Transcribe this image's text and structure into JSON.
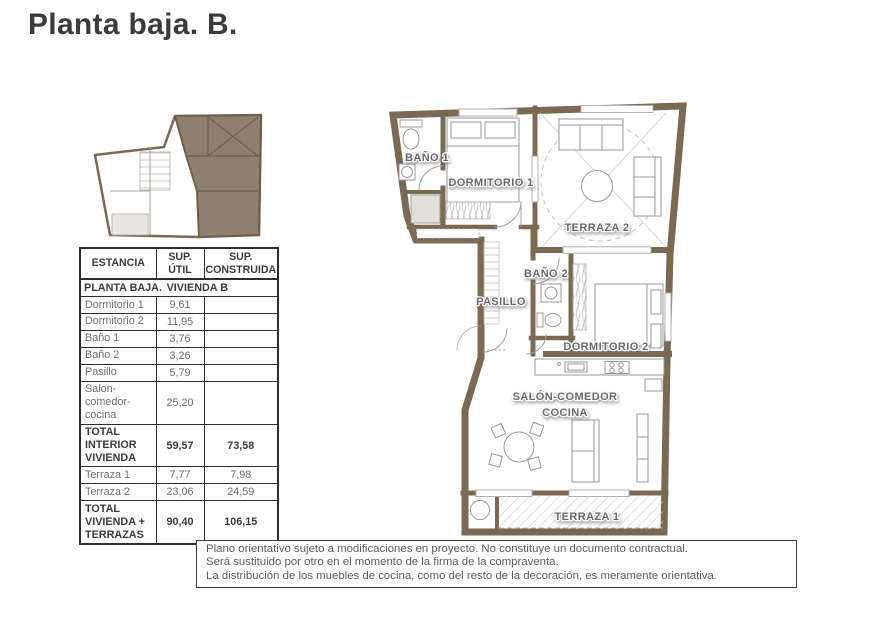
{
  "title": "Planta baja. B.",
  "table": {
    "col_headers": [
      "ESTANCIA",
      "SUP. ÚTIL",
      "SUP. CONSTRUIDA"
    ],
    "section": {
      "left": "PLANTA BAJA.",
      "right": "VIVIENDA B"
    },
    "rows": [
      {
        "label": "Dormitorio 1",
        "util": "9,61",
        "cons": ""
      },
      {
        "label": "Dormitorio 2",
        "util": "11,95",
        "cons": ""
      },
      {
        "label": "Baño 1",
        "util": "3,76",
        "cons": ""
      },
      {
        "label": "Baño 2",
        "util": "3,26",
        "cons": ""
      },
      {
        "label": "Pasillo",
        "util": "5,79",
        "cons": ""
      },
      {
        "label": "Salon-comedor-cocina",
        "util": "25,20",
        "cons": ""
      },
      {
        "label": "TOTAL INTERIOR VIVIENDA",
        "util": "59,57",
        "cons": "73,58"
      },
      {
        "label": "Terraza 1",
        "util": "7,77",
        "cons": "7,98"
      },
      {
        "label": "Terraza 2",
        "util": "23,06",
        "cons": "24,59"
      },
      {
        "label": "TOTAL VIVIENDA + TERRAZAS",
        "util": "90,40",
        "cons": "106,15"
      }
    ]
  },
  "floor_plan": {
    "labels": {
      "bano1": "BAÑO 1",
      "dormitorio1": "DORMITORIO 1",
      "terraza2": "TERRAZA 2",
      "bano2": "BAÑO 2",
      "pasillo": "PASILLO",
      "dormitorio2": "DORMITORIO 2",
      "salon_line1": "SALÓN-COMEDOR",
      "salon_line2": "COCINA",
      "terraza1": "TERRAZA 1"
    }
  },
  "disclaimer": {
    "lines": [
      "Plano orientativo sujeto a modificaciones en proyecto. No constituye un documento contractual.",
      "Será sustituido por otro en el momento de la firma de la compraventa.",
      "La distribución de los muebles de cocina, como del resto de la decoración, es meramente orientativa."
    ]
  },
  "colors": {
    "wall_brown": "#7b6a53",
    "keyplan_highlight": "#8e8071",
    "label_gray": "#67686c",
    "table_text_dark": "#3b3b3d",
    "table_text_light": "#6b6c6f"
  }
}
